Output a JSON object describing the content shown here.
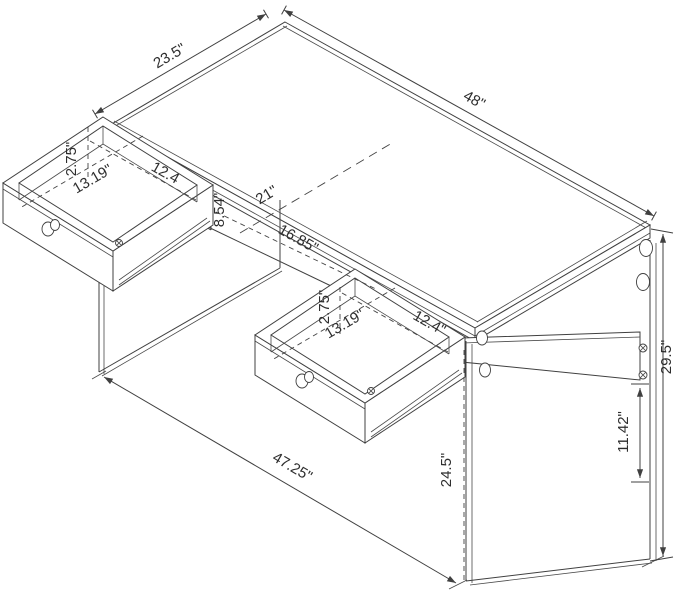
{
  "diagram": {
    "type": "furniture-dimension-drawing",
    "subject": "writing desk with glass side panels and two drawers",
    "background_color": "#ffffff",
    "line_color": "#404040",
    "text_color": "#2e2e2e",
    "units": "inches"
  },
  "labels": {
    "desktop_depth": "23.5\"",
    "desktop_width": "48\"",
    "overall_height": "29.5\"",
    "support_to_floor": "11.42\"",
    "knee_clearance_height": "24.5\"",
    "base_width": "47.25\"",
    "knee_opening_width": "21\"",
    "rail_length": "16.85\"",
    "drawer_back_clearance": "8.54\"",
    "left_drawer_inner_height": "2.75\"",
    "left_drawer_inner_depth": "13.19\"",
    "left_drawer_inner_width": "12.4",
    "center_drawer_inner_height": "2.75\"",
    "center_drawer_inner_depth": "13.19\"",
    "center_drawer_inner_width": "12.4\""
  }
}
